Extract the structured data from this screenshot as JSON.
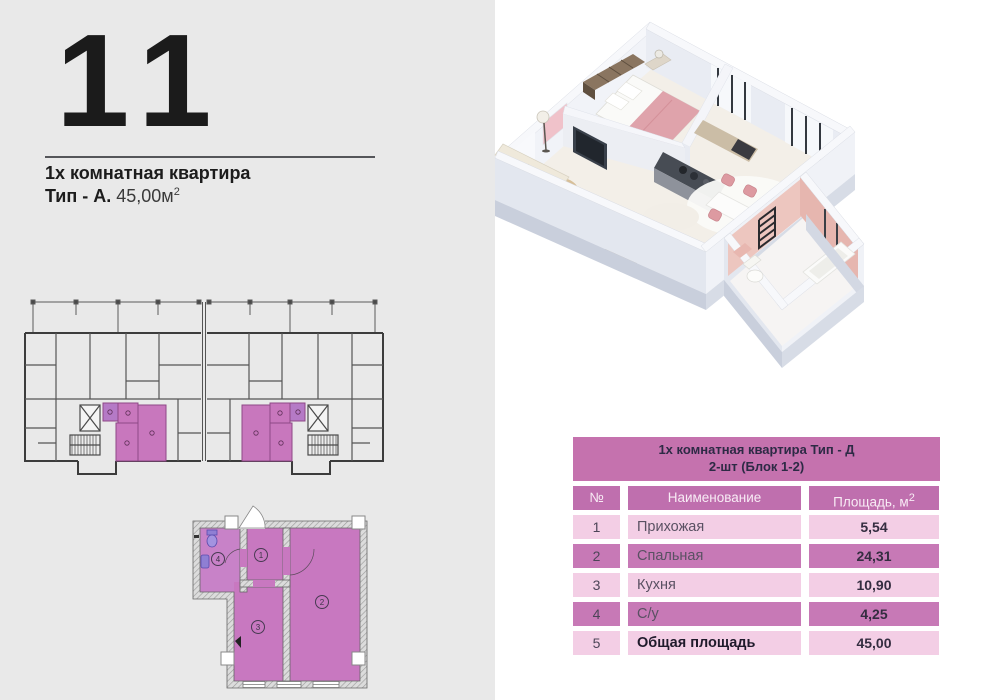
{
  "header": {
    "number": "11",
    "subtitle": "1х комнатная квартира",
    "type_label": "Тип - А.",
    "area_value": "45,00м",
    "area_sup": "2"
  },
  "table": {
    "title_line1": "1х комнатная квартира Тип - Д",
    "title_line2": "2-шт (Блок 1-2)",
    "col_num": "№",
    "col_name": "Наименование",
    "col_area": "Площадь, м",
    "col_area_sup": "2",
    "rows": [
      {
        "num": "1",
        "name": "Прихожая",
        "area": "5,54"
      },
      {
        "num": "2",
        "name": "Спальная",
        "area": "24,31"
      },
      {
        "num": "3",
        "name": "Кухня",
        "area": "10,90"
      },
      {
        "num": "4",
        "name": "С/у",
        "area": "4,25"
      },
      {
        "num": "5",
        "name": "Общая площадь",
        "area": "45,00"
      }
    ]
  },
  "unit_plan": {
    "room_numbers": {
      "hall": "1",
      "room": "2",
      "kitchen": "3",
      "bath": "4"
    }
  },
  "colors": {
    "panel_bg": "#e9e9e9",
    "table_title_bg": "#c572ae",
    "table_header_bg": "#bf6fae",
    "row_light": "#f3cee5",
    "row_dark": "#c779b6",
    "plan_pink": "#c878c0",
    "building_highlight_pink": "#c877bd",
    "bathroom_fixture_violet": "#8f7fd4",
    "render_blanket_pink": "#dfa3ab",
    "render_wall_white": "#f0f2f7"
  }
}
